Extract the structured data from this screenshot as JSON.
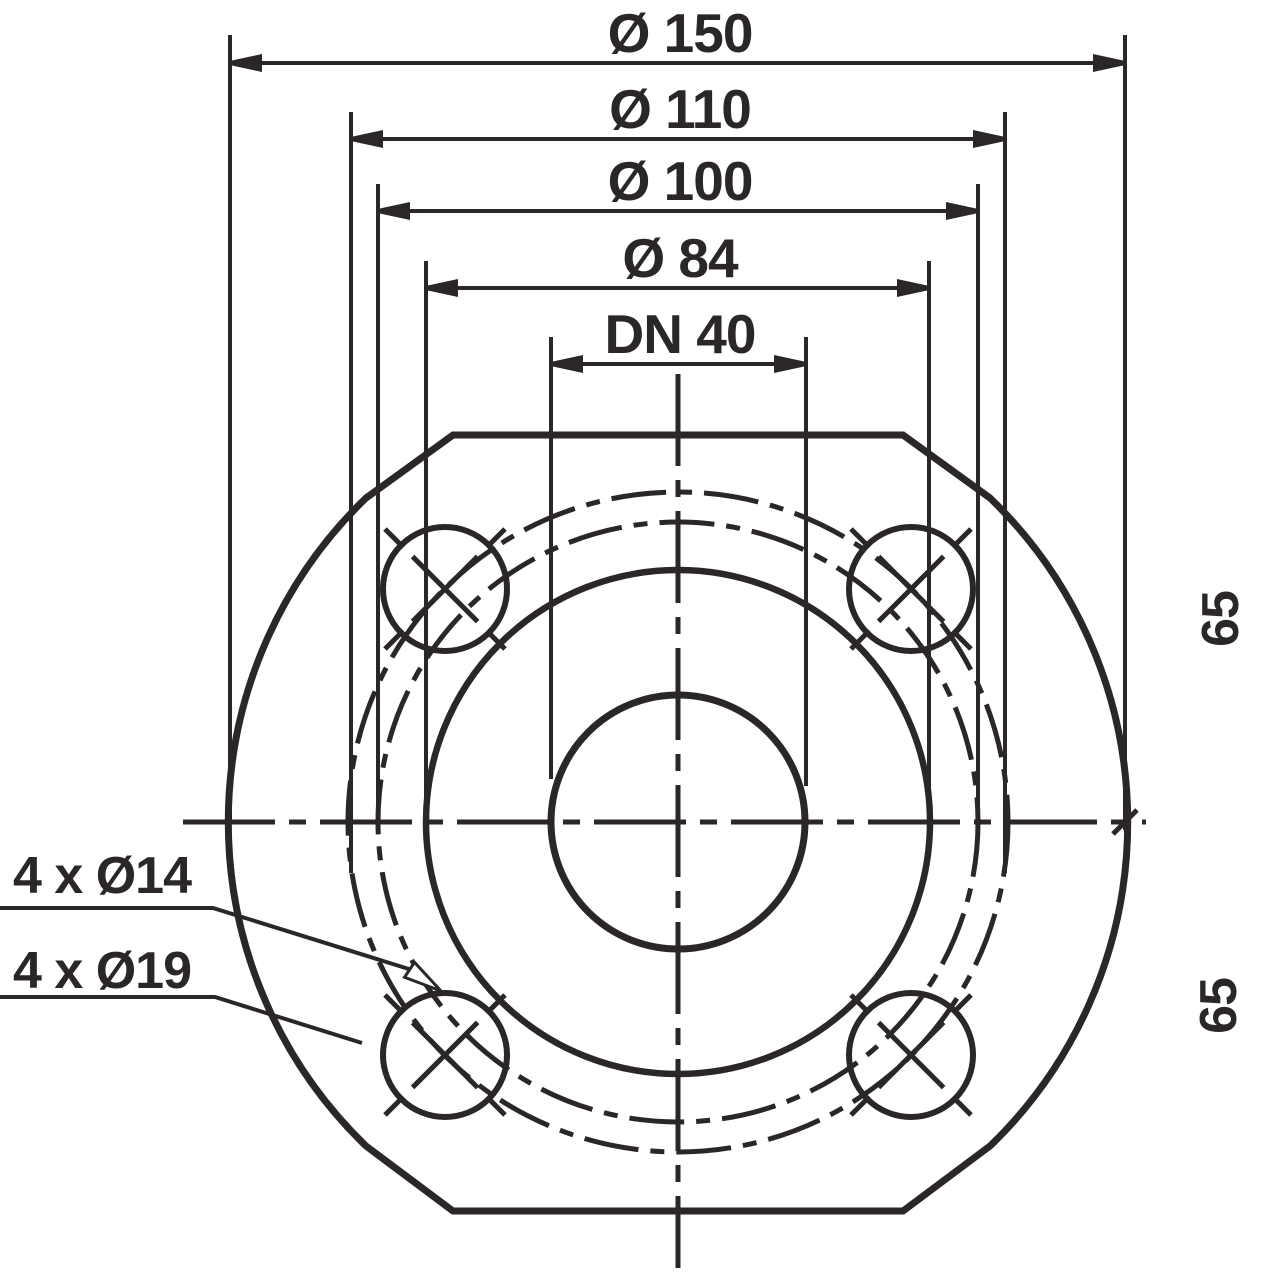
{
  "drawing": {
    "dimensions": {
      "outer_diameter": "Ø 150",
      "bolt_circle_large": "Ø 110",
      "bolt_circle_small": "Ø 100",
      "raised_face": "Ø 84",
      "nominal_bore": "DN 40",
      "center_to_top": "65",
      "center_to_bottom": "65"
    },
    "hole_notes": {
      "small_holes": "4 x Ø14",
      "large_holes": "4 x Ø19"
    },
    "colors": {
      "ink": "#2b2629",
      "background": "#ffffff"
    }
  }
}
